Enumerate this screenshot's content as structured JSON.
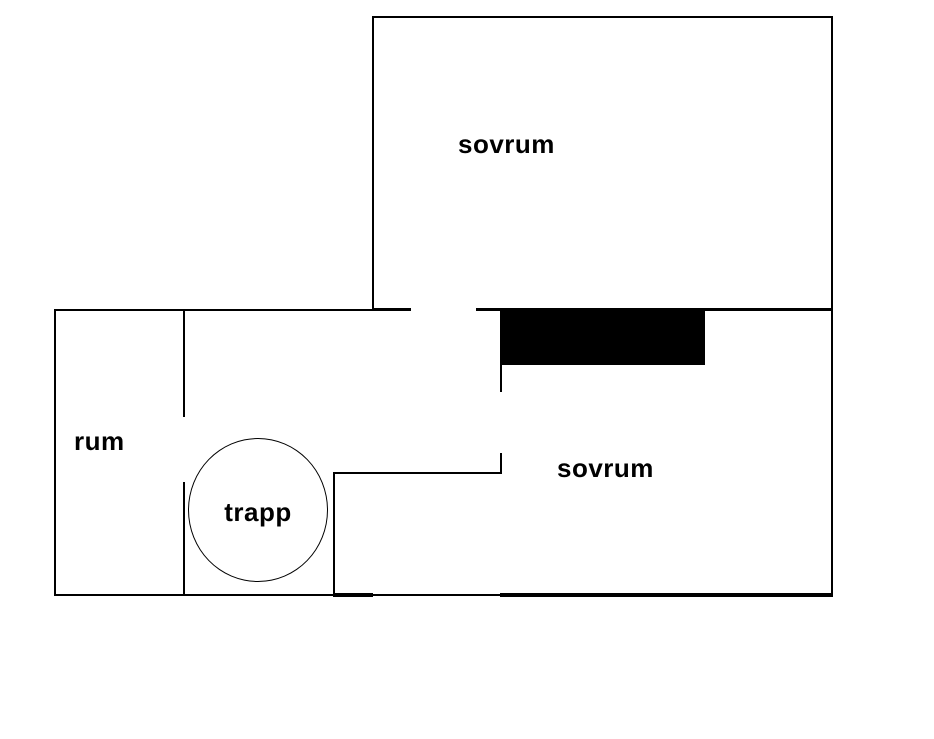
{
  "diagram": {
    "type": "floorplan",
    "background_color": "#ffffff",
    "line_color": "#000000",
    "filled_block_color": "#000000",
    "rooms": {
      "upper_bedroom": {
        "label": "sovrum"
      },
      "lower_bedroom": {
        "label": "sovrum"
      },
      "side_room": {
        "label": "rum"
      },
      "stairs": {
        "label": "trapp"
      }
    }
  }
}
